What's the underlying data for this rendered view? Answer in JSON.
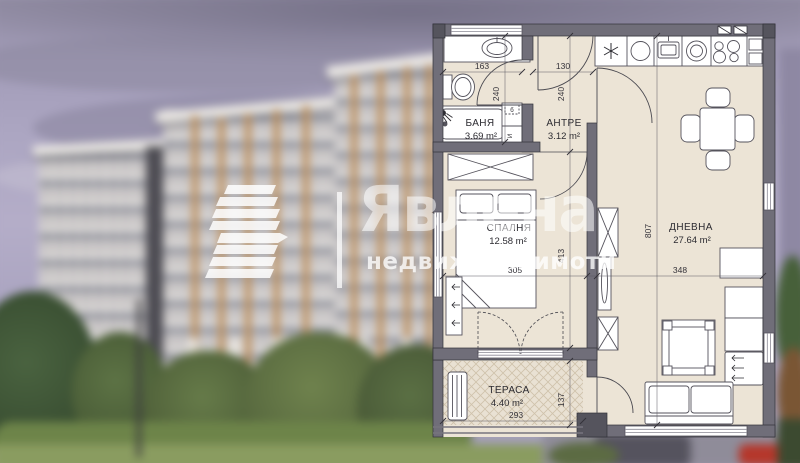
{
  "watermark": {
    "brand": "Явлена",
    "tagline": "недвижими имоти",
    "color": "#ffffff"
  },
  "floor_plan": {
    "rooms": {
      "bathroom": {
        "name": "БАНЯ",
        "area": "3.69 m²"
      },
      "hall": {
        "name": "АНТРЕ",
        "area": "3.12 m²"
      },
      "bedroom": {
        "name": "СПАЛНЯ",
        "area": "12.58 m²"
      },
      "living": {
        "name": "ДНЕВНА",
        "area": "27.64 m²"
      },
      "terrace": {
        "name": "ТЕРАСА",
        "area": "4.40 m²"
      }
    },
    "dimensions": {
      "bath_width_cm": "163",
      "entrance_door_cm": "130",
      "bath_depth_cm": "240",
      "hall_depth_cm": "240",
      "bedroom_width_cm": "305",
      "bedroom_depth_cm": "413",
      "living_depth_cm": "807",
      "living_width_cm": "348",
      "terrace_width_cm": "293",
      "terrace_depth_cm": "137"
    },
    "annotations": {
      "washer_label_top": "б",
      "washer_label_side": "И"
    },
    "colors": {
      "wall": "#706e79",
      "floor": "#ece4d6",
      "terrace_hatch": "#cfc2ab",
      "furniture": "#ffffff",
      "line": "#4a4950"
    }
  },
  "background": {
    "sky_color": "#aea8c4",
    "building_facade_color": "#cfcac7",
    "building_accent_color": "#ba8952",
    "dark_core_color": "#4c4b52",
    "greenery_color": "#5f7547",
    "lawn_color": "#8a9c60",
    "street_color": "#8f8c99",
    "car_color": "#b5372b"
  }
}
